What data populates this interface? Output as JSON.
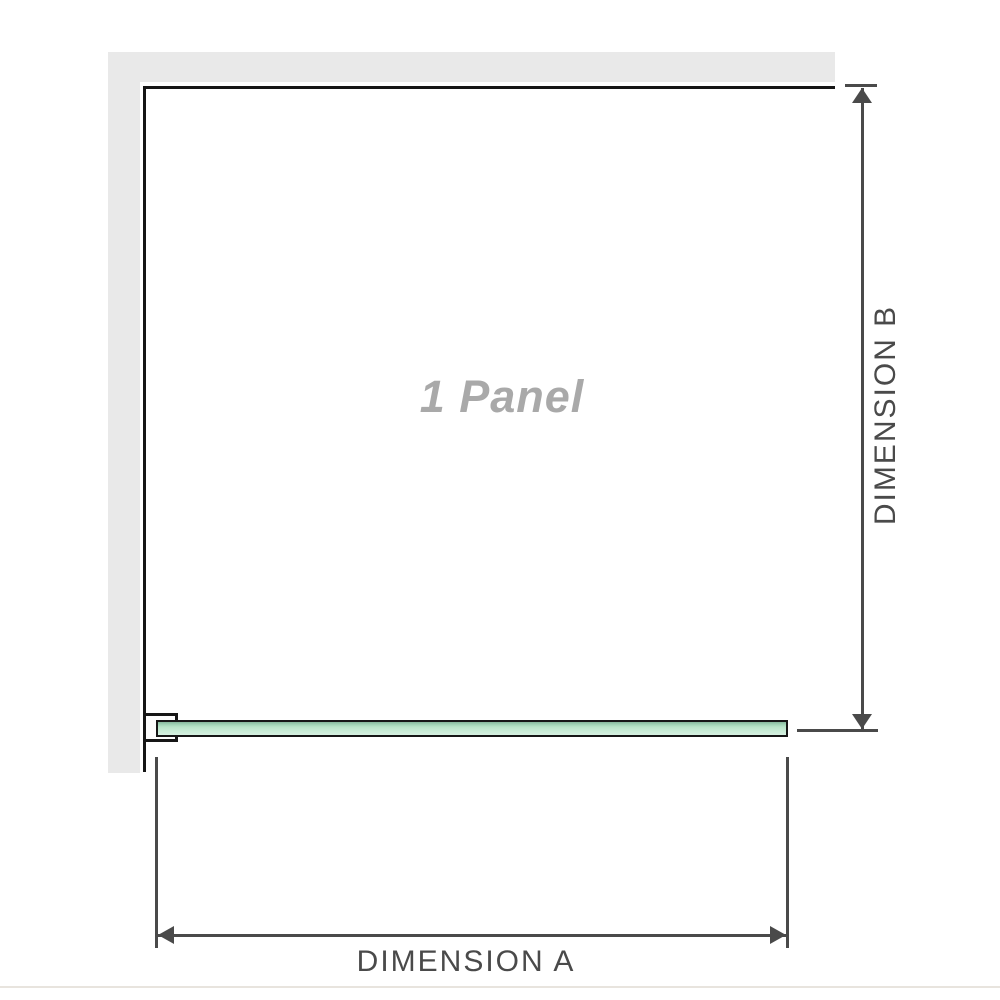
{
  "diagram": {
    "title": "shower screen single panel plan-view diagram",
    "panel_label": "1 Panel",
    "dimension_a_label": "DIMENSION A",
    "dimension_b_label": "DIMENSION B",
    "colors": {
      "wall_gray": "#e9e9e9",
      "outline_black": "#161616",
      "glass_green": "#b7e4c8",
      "dimension_gray": "#4a4a4a",
      "panel_label_gray": "#a9a9a9",
      "divider_beige": "#e8e4de"
    }
  }
}
